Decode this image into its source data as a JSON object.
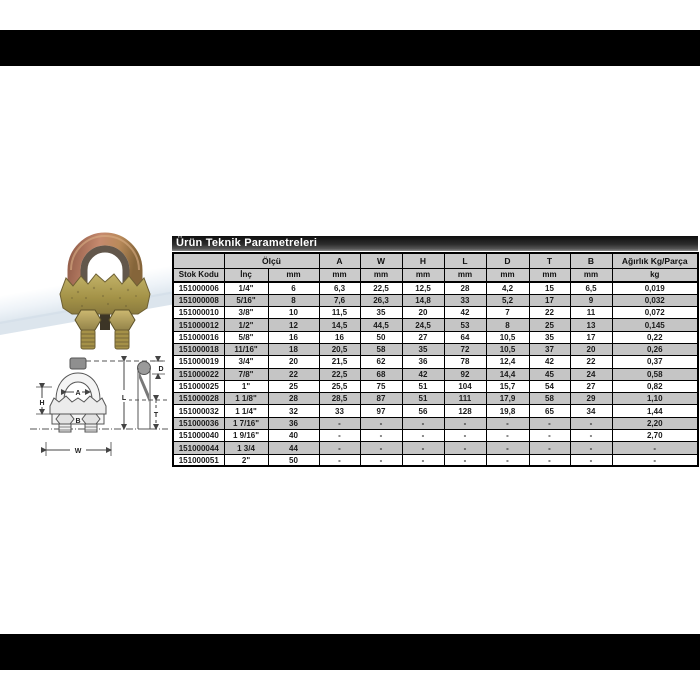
{
  "page": {
    "bar_color": "#000000",
    "background": "#ffffff"
  },
  "table": {
    "title": "Ürün Teknik Parametreleri",
    "header": {
      "stok_kodu": "Stok Kodu",
      "olcu_group": "Ölçü",
      "inc": "İnç",
      "mm": "mm",
      "kg": "kg",
      "dims": [
        "A",
        "W",
        "H",
        "L",
        "D",
        "T",
        "B"
      ],
      "weight_group": "Ağırlık Kg/Parça"
    },
    "rows": [
      [
        "151000006",
        "1/4\"",
        "6",
        "6,3",
        "22,5",
        "12,5",
        "28",
        "4,2",
        "15",
        "6,5",
        "0,019"
      ],
      [
        "151000008",
        "5/16\"",
        "8",
        "7,6",
        "26,3",
        "14,8",
        "33",
        "5,2",
        "17",
        "9",
        "0,032"
      ],
      [
        "151000010",
        "3/8\"",
        "10",
        "11,5",
        "35",
        "20",
        "42",
        "7",
        "22",
        "11",
        "0,072"
      ],
      [
        "151000012",
        "1/2\"",
        "12",
        "14,5",
        "44,5",
        "24,5",
        "53",
        "8",
        "25",
        "13",
        "0,145"
      ],
      [
        "151000016",
        "5/8\"",
        "16",
        "16",
        "50",
        "27",
        "64",
        "10,5",
        "35",
        "17",
        "0,22"
      ],
      [
        "151000018",
        "11/16\"",
        "18",
        "20,5",
        "58",
        "35",
        "72",
        "10,5",
        "37",
        "20",
        "0,26"
      ],
      [
        "151000019",
        "3/4\"",
        "20",
        "21,5",
        "62",
        "36",
        "78",
        "12,4",
        "42",
        "22",
        "0,37"
      ],
      [
        "151000022",
        "7/8\"",
        "22",
        "22,5",
        "68",
        "42",
        "92",
        "14,4",
        "45",
        "24",
        "0,58"
      ],
      [
        "151000025",
        "1\"",
        "25",
        "25,5",
        "75",
        "51",
        "104",
        "15,7",
        "54",
        "27",
        "0,82"
      ],
      [
        "151000028",
        "1 1/8\"",
        "28",
        "28,5",
        "87",
        "51",
        "111",
        "17,9",
        "58",
        "29",
        "1,10"
      ],
      [
        "151000032",
        "1 1/4\"",
        "32",
        "33",
        "97",
        "56",
        "128",
        "19,8",
        "65",
        "34",
        "1,44"
      ],
      [
        "151000036",
        "1 7/16\"",
        "36",
        "-",
        "-",
        "-",
        "-",
        "-",
        "-",
        "-",
        "2,20"
      ],
      [
        "151000040",
        "1 9/16\"",
        "40",
        "-",
        "-",
        "-",
        "-",
        "-",
        "-",
        "-",
        "2,70"
      ],
      [
        "151000044",
        "1 3/4",
        "44",
        "-",
        "-",
        "-",
        "-",
        "-",
        "-",
        "-",
        "-"
      ],
      [
        "151000051",
        "2\"",
        "50",
        "-",
        "-",
        "-",
        "-",
        "-",
        "-",
        "-",
        "-"
      ]
    ],
    "colors": {
      "title_bg": "#1c1c1c",
      "title_text": "#ffffff",
      "header_bg": "#cbcbcb",
      "alt_row_bg": "#c5c5c5",
      "row_bg": "#ffffff",
      "border": "#000000"
    }
  },
  "diagram": {
    "labels": {
      "A": "A",
      "H": "H",
      "B": "B",
      "W": "W",
      "L": "L",
      "D": "D",
      "T": "T"
    }
  },
  "product": {
    "finish_colors": {
      "copper": "#b97a62",
      "gold": "#b3a55e",
      "olive": "#948344"
    }
  }
}
